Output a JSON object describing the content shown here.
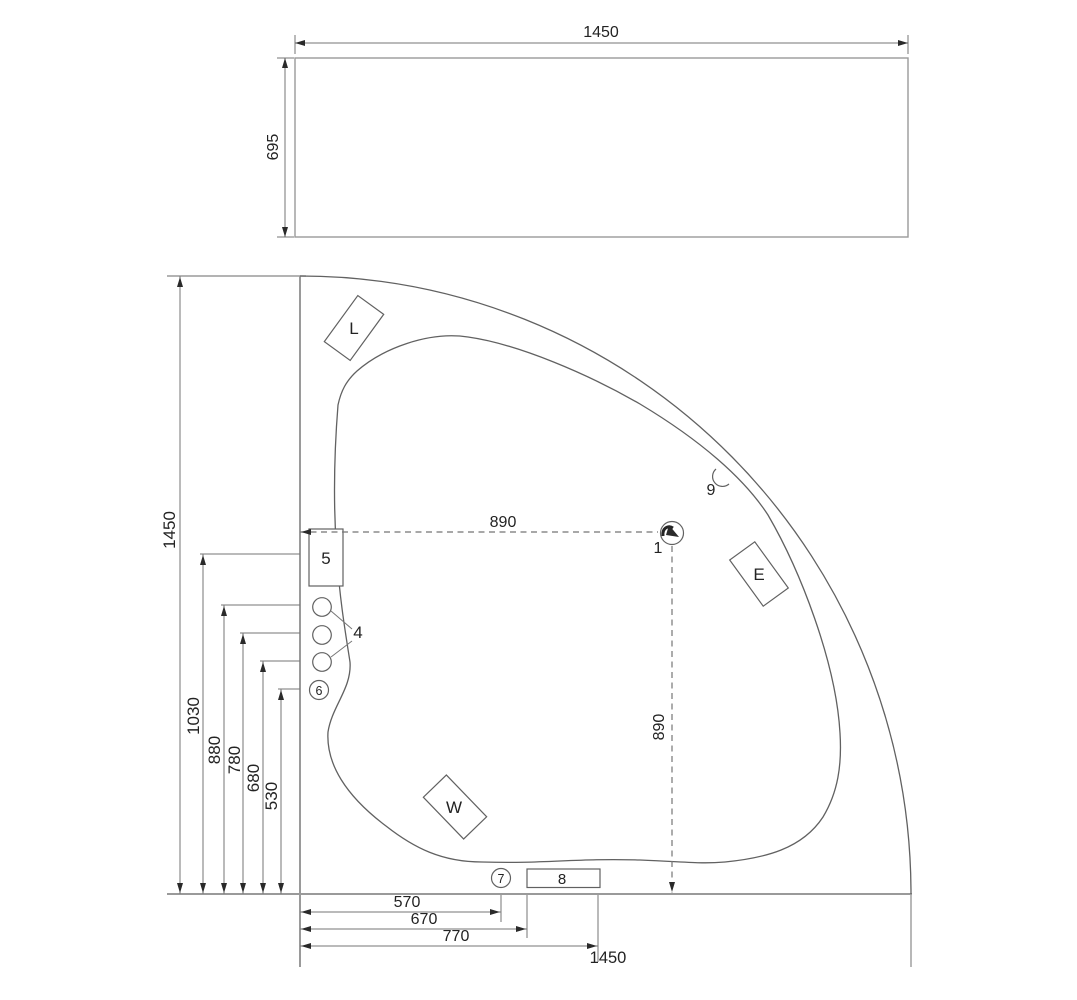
{
  "colors": {
    "line": "#616161",
    "wall": "#9a9a9a",
    "text": "#232323"
  },
  "front_panel": {
    "width": "1450",
    "height": "695"
  },
  "plan": {
    "side": "1450",
    "center_offset_x": "890",
    "center_offset_y": "890",
    "left_dims": [
      "1030",
      "880",
      "780",
      "680",
      "530"
    ],
    "bottom_dims": [
      "570",
      "670",
      "770"
    ],
    "bottom_total": "1450",
    "callouts": {
      "n1": "1",
      "n4": "4",
      "n5": "5",
      "n6": "6",
      "n7": "7",
      "n8": "8",
      "n9": "9",
      "L": "L",
      "E": "E",
      "W": "W"
    }
  }
}
